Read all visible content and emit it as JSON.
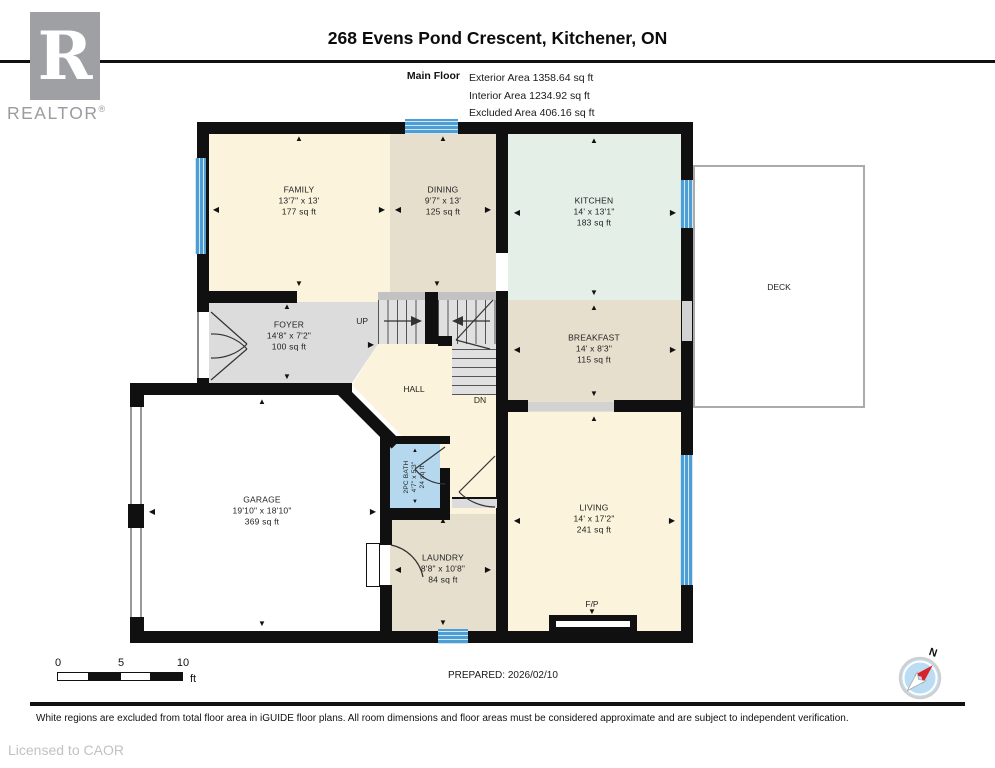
{
  "header": {
    "logo": {
      "letter": "R",
      "brand": "REALTOR",
      "registered": "®"
    },
    "title": "268 Evens Pond Crescent, Kitchener, ON",
    "floor_label": "Main Floor",
    "areas": [
      "Exterior Area 1358.64 sq ft",
      "Interior Area 1234.92 sq ft",
      "Excluded Area 406.16 sq ft"
    ]
  },
  "rooms": [
    {
      "name": "FAMILY",
      "dims": "13'7\" x 13'",
      "area": "177 sq ft"
    },
    {
      "name": "DINING",
      "dims": "9'7\" x 13'",
      "area": "125 sq ft"
    },
    {
      "name": "KITCHEN",
      "dims": "14' x 13'1\"",
      "area": "183 sq ft"
    },
    {
      "name": "BREAKFAST",
      "dims": "14' x 8'3\"",
      "area": "115 sq ft"
    },
    {
      "name": "FOYER",
      "dims": "14'8\" x 7'2\"",
      "area": "100 sq ft"
    },
    {
      "name": "HALL"
    },
    {
      "name": "GARAGE",
      "dims": "19'10\" x 18'10\"",
      "area": "369 sq ft"
    },
    {
      "name": "2PC BATH",
      "dims": "4'7\" x 5'3\"",
      "area": "24 sq ft"
    },
    {
      "name": "LAUNDRY",
      "dims": "8'8\" x 10'8\"",
      "area": "84 sq ft"
    },
    {
      "name": "LIVING",
      "dims": "14' x 17'2\"",
      "area": "241 sq ft"
    },
    {
      "name": "DECK"
    }
  ],
  "plan_labels": {
    "up": "UP",
    "dn": "DN",
    "fireplace": "F/P",
    "north": "N"
  },
  "scale_bar": {
    "ticks": [
      "0",
      "5",
      "10"
    ],
    "unit": "ft"
  },
  "prepared": "PREPARED: 2026/02/10",
  "footer": {
    "disclaimer": "White regions are excluded from total floor area in iGUIDE floor plans. All room dimensions and floor areas must be considered approximate and are subject to independent verification.",
    "license": "Licensed to CAOR"
  },
  "glyphs": {
    "up": "▲",
    "down": "▼",
    "left": "◀",
    "right": "▶"
  },
  "colors": {
    "wall": "#101010",
    "window": "#4d9ed5",
    "room_cream": "#fbf3db",
    "room_beige": "#e7dfce",
    "room_mint": "#e3efe7",
    "room_gray": "#dcdcdc",
    "bath_blue": "#b5d8ee",
    "compass_red": "#d8232a"
  }
}
